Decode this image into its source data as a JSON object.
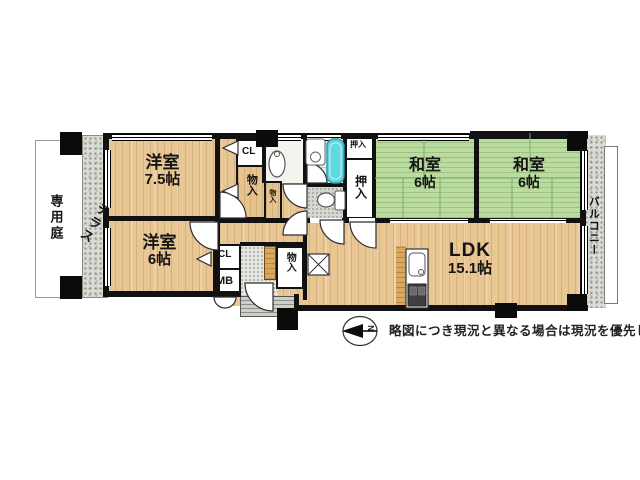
{
  "plan": {
    "rooms": {
      "west75": {
        "name": "洋室",
        "size": "7.5帖"
      },
      "west6": {
        "name": "洋室",
        "size": "6帖"
      },
      "washitsu_left": {
        "name": "和室",
        "size": "6帖"
      },
      "washitsu_right": {
        "name": "和室",
        "size": "6帖"
      },
      "ldk": {
        "name": "LDK",
        "size": "15.1帖"
      }
    },
    "outdoor": {
      "private_garden": "専用庭",
      "terrace": "テラス",
      "balcony": "バルコニー"
    },
    "storage": {
      "closet_west75": "CL",
      "storage_west75": "物入",
      "storage_hall_small": "物入",
      "oshiire_top": "押入",
      "oshiire_main": "押入",
      "closet_west6": "CL",
      "meter_box": "MB",
      "storage_entry": "物入"
    },
    "compass": {
      "north": "N"
    },
    "note": "略図につき現況と異なる場合は現況を優先します",
    "colors": {
      "wood_floor": "#e9c795",
      "tatami_green": "#badc9f",
      "bathtub_cyan": "#5fd8df",
      "wall_black": "#111111",
      "outdoor_gray": "#dbdbd5"
    }
  }
}
